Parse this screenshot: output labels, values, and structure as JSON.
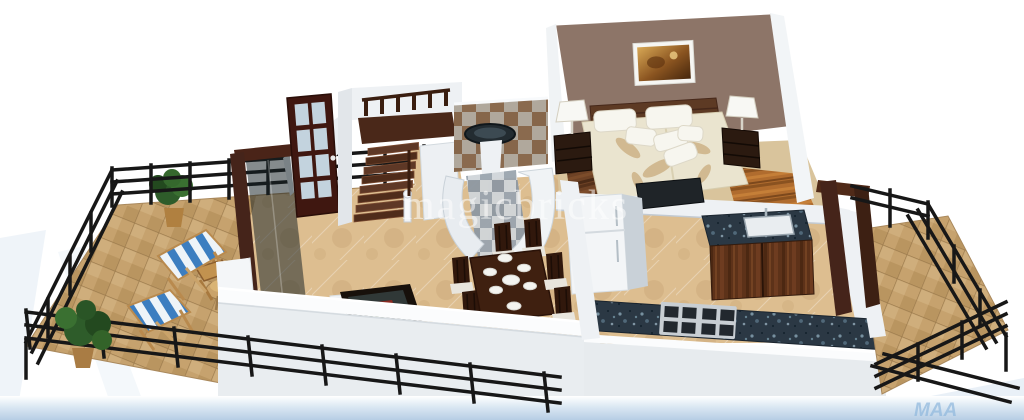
{
  "watermark": {
    "text": "magicbricks"
  },
  "corner_mark": {
    "text": "MAA"
  },
  "palette": {
    "background": "#ffffff",
    "bottom_fade_blue": "#b6cde4",
    "wall_face": "#eef1f4",
    "wall_face_shaded": "#e9edf0",
    "wall_side": "#c2cad2",
    "wall_top": "#fbfcfd",
    "accent_wall_brown": "#8d7568",
    "dark_wood": "#45241a",
    "door_wood": "#3f1710",
    "railing_black": "#171717",
    "balcony_tile_tan": "#c6a26e",
    "marble_floor_beige": "#ddbe90",
    "granite_dark": "#2b3844",
    "bed_cover_cream": "#eae4cf",
    "leaf_motif_tan": "#cdb287",
    "pillow_white": "#f7f6ef",
    "lamp_shade_white": "#f8f8f4",
    "deck_chair_blue": "#3c7ec0",
    "deck_chair_white": "#eef4f8",
    "plant_green": "#2e5c2a",
    "glass_pane_blue": "#cfe4f0",
    "checker_wall_brown": "#86664a",
    "checker_wall_grey": "#b0a89c",
    "tv_screen_dark": "#1f2428",
    "art_gold": "#c89b4e"
  },
  "scene": {
    "type": "3d-isometric-floor-plan-render",
    "rooms": [
      "balcony-left",
      "living-room",
      "dining-area",
      "entrance-foyer",
      "staircase",
      "bathroom",
      "bedroom",
      "kitchen",
      "balcony-right"
    ],
    "furniture": [
      "deck-chairs",
      "potted-plants",
      "patio-table-with-hat",
      "folding-chair",
      "sofa",
      "glass-coffee-table",
      "dining-table-six-chairs",
      "glazed-entry-door",
      "wooden-stairs",
      "wash-basin",
      "double-bed",
      "bedside-tables",
      "table-lamps",
      "wall-painting",
      "tv-panel",
      "refrigerator",
      "sink-cabinet",
      "gas-hob",
      "granite-counter",
      "metal-railings"
    ]
  }
}
